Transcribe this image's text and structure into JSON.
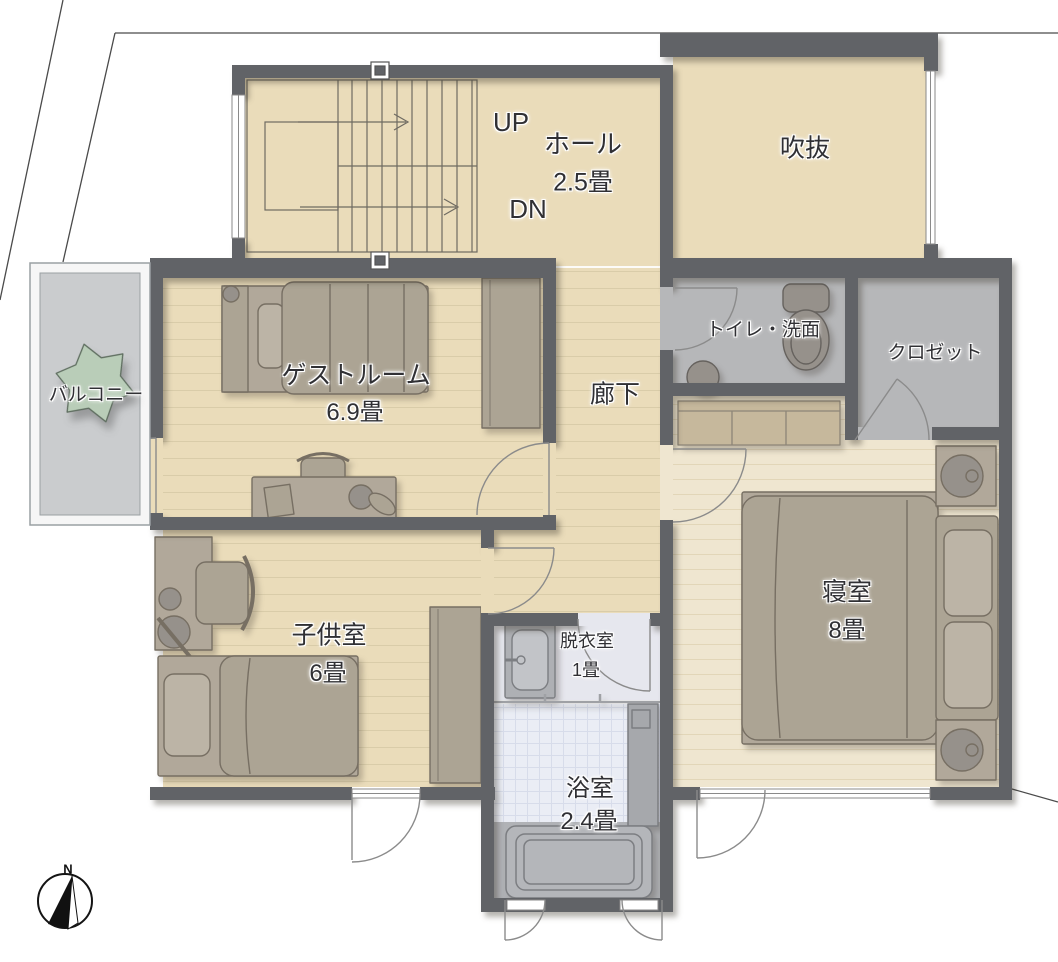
{
  "plan": {
    "rooms": {
      "hall": {
        "name": "ホール",
        "size": "2.5畳"
      },
      "void": {
        "name": "吹抜"
      },
      "guest": {
        "name": "ゲストルーム",
        "size": "6.9畳"
      },
      "balcony": {
        "name": "バルコニー"
      },
      "corridor": {
        "name": "廊下"
      },
      "toilet": {
        "name": "トイレ・洗面"
      },
      "closet": {
        "name": "クロゼット"
      },
      "child": {
        "name": "子供室",
        "size": "6畳"
      },
      "bedroom": {
        "name": "寝室",
        "size": "8畳"
      },
      "dressing": {
        "name": "脱衣室",
        "size": "1畳"
      },
      "bath": {
        "name": "浴室",
        "size": "2.4畳"
      }
    },
    "stairs": {
      "up": "UP",
      "down": "DN"
    },
    "compass": {
      "north_label": "N"
    },
    "colors": {
      "wall": "#616367",
      "floor_wood": "#eadcba",
      "floor_wood_light": "#efe6d0",
      "floor_gray": "#b6b7b9",
      "balcony_floor": "#caccce",
      "bath_floor": "#eaedf5",
      "dressing_floor": "#e6e7ee",
      "plant": "#b9cdb8",
      "furniture": "#aca494",
      "cabinet": "#c6b89c",
      "tub": "#b4b6ba"
    }
  }
}
